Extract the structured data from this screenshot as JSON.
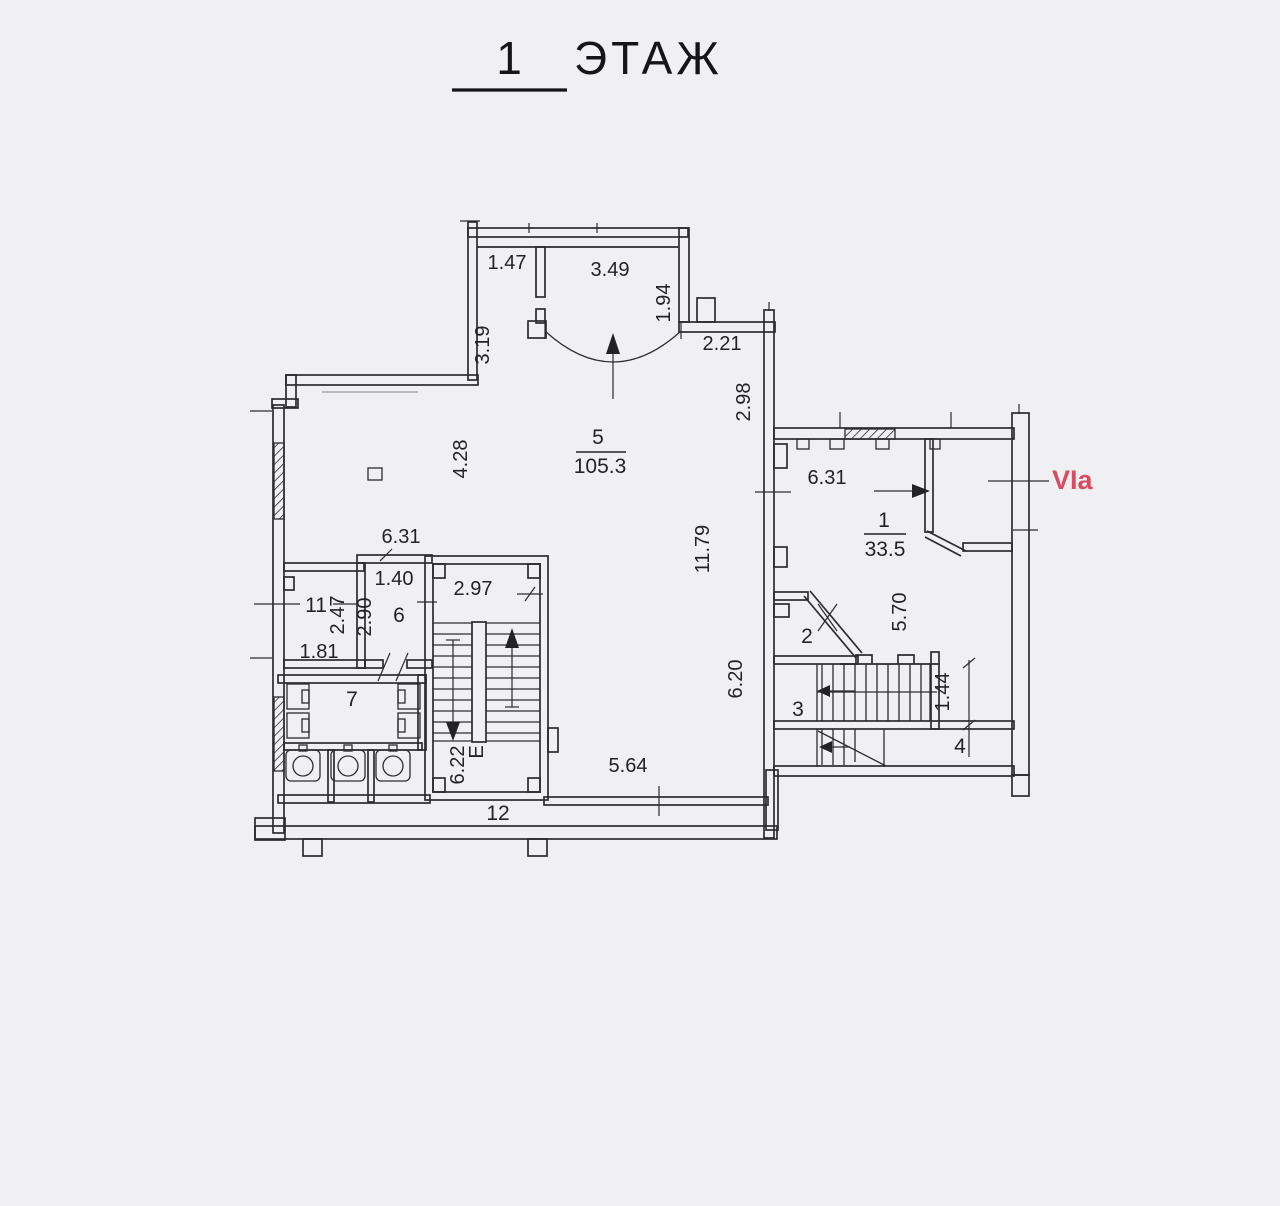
{
  "title": {
    "number": "1",
    "word": "ЭТАЖ"
  },
  "plan": {
    "rooms": {
      "r1": {
        "number": "1",
        "area": "33.5"
      },
      "r2": {
        "number": "2"
      },
      "r3": {
        "number": "3"
      },
      "r4": {
        "number": "4"
      },
      "r5": {
        "number": "5",
        "area": "105.3"
      },
      "r6": {
        "number": "6"
      },
      "r7": {
        "number": "7"
      },
      "r11": {
        "number": "11"
      },
      "r12": {
        "number": "12"
      },
      "stairwell": {
        "letter": "Е"
      }
    },
    "dimensions": {
      "entry_left_width": "1.47",
      "entry_width": "3.49",
      "entry_left_depth": "3.19",
      "entry_right_depth": "1.94",
      "link_width": "2.21",
      "link_depth": "2.98",
      "hall_upper_depth": "4.28",
      "hall_width": "6.31",
      "hall_right_depth": "11.79",
      "hall_lower_depth": "6.20",
      "hall_bottom_width": "5.64",
      "room1_width": "6.31",
      "room1_depth": "5.70",
      "room6_width": "1.40",
      "room6_depth": "2.90",
      "room11_depth": "2.47",
      "room11_width": "1.81",
      "stair_width": "2.97",
      "stair_depth": "6.22",
      "room3_stair_width": "1.44"
    },
    "annotations": {
      "unit": "VIa"
    }
  },
  "colors": {
    "accent_red": "#d84b63",
    "line": "#2c2c30",
    "paper": "#f0eff2"
  }
}
